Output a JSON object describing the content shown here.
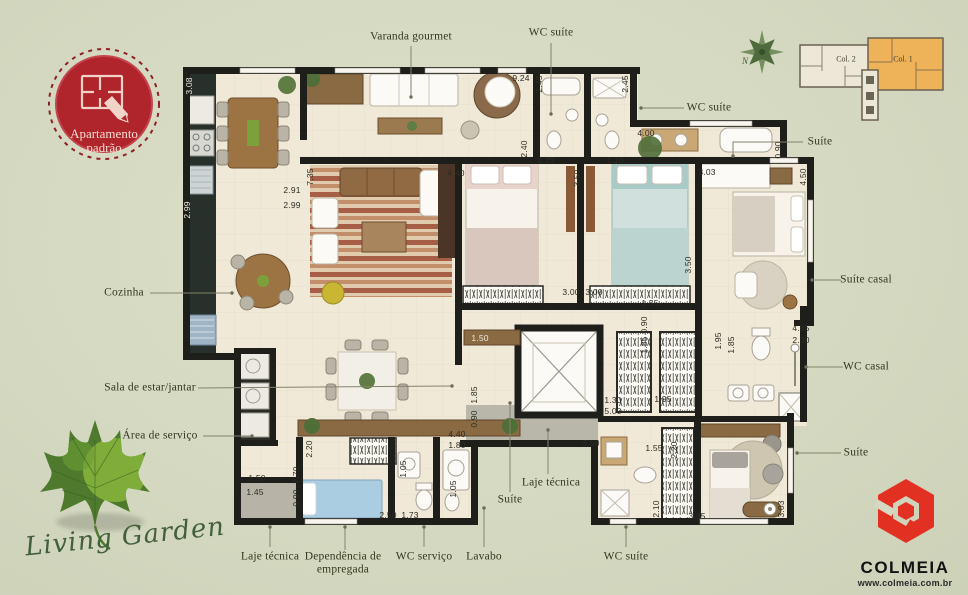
{
  "badge": {
    "line1": "Apartamento",
    "line2": "padrão"
  },
  "compass": {
    "n": "N"
  },
  "keyplan": {
    "col2": "Col. 2",
    "col1": "Col. 1"
  },
  "brand": {
    "name": "COLMEIA",
    "url": "www.colmeia.com.br",
    "red": "#e23122"
  },
  "watermark": {
    "text": "Living Garden"
  },
  "colors": {
    "background": "#d5d9c1",
    "wall": "#1e1e1b",
    "floor": "#f0e9d8",
    "badge_red": "#b0242b",
    "keyplan_orange": "#eeb259",
    "leaf_green": "#557a2e"
  },
  "plan": {
    "labels": [
      {
        "id": "varanda-gourmet",
        "text": "Varanda gourmet",
        "x": 411,
        "y": 37,
        "leader": [
          [
            411,
            46
          ],
          [
            411,
            97
          ]
        ]
      },
      {
        "id": "wc-suite-top",
        "text": "WC suíte",
        "x": 551,
        "y": 33,
        "leader": [
          [
            551,
            43
          ],
          [
            551,
            114
          ]
        ]
      },
      {
        "id": "wc-suite-top-right",
        "text": "WC suíte",
        "x": 709,
        "y": 108,
        "leader": [
          [
            684,
            108
          ],
          [
            641,
            108
          ]
        ]
      },
      {
        "id": "suite-top-right",
        "text": "Suíte",
        "x": 820,
        "y": 142,
        "leader": [
          [
            803,
            142
          ],
          [
            733,
            142
          ],
          [
            733,
            156
          ]
        ]
      },
      {
        "id": "cozinha",
        "text": "Cozinha",
        "x": 124,
        "y": 293,
        "leader": [
          [
            150,
            293
          ],
          [
            232,
            293
          ]
        ]
      },
      {
        "id": "sala-estar-jantar",
        "text": "Sala de estar/jantar",
        "x": 150,
        "y": 388,
        "leader": [
          [
            198,
            388
          ],
          [
            452,
            386
          ]
        ]
      },
      {
        "id": "area-servico",
        "text": "Área de serviço",
        "x": 160,
        "y": 436,
        "leader": [
          [
            203,
            436
          ],
          [
            252,
            436
          ]
        ]
      },
      {
        "id": "suite-casal",
        "text": "Suíte casal",
        "x": 866,
        "y": 280,
        "leader": [
          [
            841,
            280
          ],
          [
            812,
            280
          ]
        ]
      },
      {
        "id": "wc-casal",
        "text": "WC casal",
        "x": 866,
        "y": 367,
        "leader": [
          [
            843,
            367
          ],
          [
            806,
            367
          ]
        ]
      },
      {
        "id": "suite-right",
        "text": "Suíte",
        "x": 856,
        "y": 453,
        "leader": [
          [
            841,
            453
          ],
          [
            797,
            453
          ]
        ]
      },
      {
        "id": "laje-tecnica-left",
        "text": "Laje técnica",
        "x": 270,
        "y": 557,
        "leader": [
          [
            270,
            547
          ],
          [
            270,
            527
          ]
        ]
      },
      {
        "id": "dependencia-empregada",
        "lines": [
          "Dependência de",
          "empregada"
        ],
        "x": 343,
        "y": 563,
        "leader": [
          [
            345,
            550
          ],
          [
            345,
            527
          ]
        ]
      },
      {
        "id": "wc-servico",
        "text": "WC serviço",
        "x": 424,
        "y": 557,
        "leader": [
          [
            424,
            547
          ],
          [
            424,
            527
          ]
        ]
      },
      {
        "id": "lavabo",
        "text": "Lavabo",
        "x": 484,
        "y": 557,
        "leader": [
          [
            484,
            547
          ],
          [
            484,
            508
          ]
        ]
      },
      {
        "id": "wc-suite-bottom",
        "text": "WC suíte",
        "x": 626,
        "y": 557,
        "leader": [
          [
            626,
            547
          ],
          [
            626,
            527
          ]
        ]
      },
      {
        "id": "laje-tecnica-center",
        "text": "Laje técnica",
        "x": 551,
        "y": 483,
        "leader": [
          [
            548,
            474
          ],
          [
            548,
            430
          ]
        ]
      },
      {
        "id": "suite-center",
        "text": "Suíte",
        "x": 510,
        "y": 500,
        "leader": [
          [
            510,
            492
          ],
          [
            510,
            403
          ]
        ]
      }
    ],
    "dims": [
      {
        "v": "9.24",
        "x": 521,
        "y": 78
      },
      {
        "v": "2.45",
        "x": 539,
        "y": 84,
        "rot": 1
      },
      {
        "v": "2.45",
        "x": 625,
        "y": 84,
        "rot": 1
      },
      {
        "v": "4.00",
        "x": 646,
        "y": 133
      },
      {
        "v": "0.90",
        "x": 778,
        "y": 150,
        "rot": 1
      },
      {
        "v": "4.50",
        "x": 803,
        "y": 177,
        "rot": 1
      },
      {
        "v": "2.40",
        "x": 524,
        "y": 149,
        "rot": 1
      },
      {
        "v": "1.25",
        "x": 546,
        "y": 160
      },
      {
        "v": "1.10",
        "x": 615,
        "y": 160
      },
      {
        "v": "4.40",
        "x": 456,
        "y": 173
      },
      {
        "v": "3.50",
        "x": 577,
        "y": 178,
        "rot": 1
      },
      {
        "v": "3.03",
        "x": 707,
        "y": 172
      },
      {
        "v": "2.91",
        "x": 292,
        "y": 190
      },
      {
        "v": "2.99",
        "x": 292,
        "y": 205
      },
      {
        "v": "7.35",
        "x": 310,
        "y": 177,
        "rot": 1
      },
      {
        "v": "3.08",
        "x": 189,
        "y": 86,
        "rot": 1,
        "light": true
      },
      {
        "v": "2.99",
        "x": 187,
        "y": 210,
        "rot": 1,
        "light": true
      },
      {
        "v": "3.00",
        "x": 571,
        "y": 292
      },
      {
        "v": "3.00",
        "x": 594,
        "y": 292
      },
      {
        "v": "1.55",
        "x": 650,
        "y": 303
      },
      {
        "v": "0.90",
        "x": 644,
        "y": 325,
        "rot": 1
      },
      {
        "v": "3.50",
        "x": 688,
        "y": 265,
        "rot": 1
      },
      {
        "v": "3.60",
        "x": 706,
        "y": 285,
        "rot": 1,
        "light": true
      },
      {
        "v": "1.85",
        "x": 644,
        "y": 345,
        "rot": 1
      },
      {
        "v": "1.95",
        "x": 718,
        "y": 341,
        "rot": 1
      },
      {
        "v": "1.85",
        "x": 731,
        "y": 345,
        "rot": 1
      },
      {
        "v": "1.95",
        "x": 663,
        "y": 399
      },
      {
        "v": "4.65",
        "x": 801,
        "y": 328
      },
      {
        "v": "2.30",
        "x": 801,
        "y": 340
      },
      {
        "v": "1.50",
        "x": 480,
        "y": 338,
        "light": true
      },
      {
        "v": "1.85",
        "x": 474,
        "y": 395,
        "rot": 1
      },
      {
        "v": "0.90",
        "x": 474,
        "y": 419,
        "rot": 1
      },
      {
        "v": "1.30",
        "x": 613,
        "y": 400
      },
      {
        "v": "5.00",
        "x": 613,
        "y": 411
      },
      {
        "v": "4.40",
        "x": 457,
        "y": 434
      },
      {
        "v": "1.80",
        "x": 457,
        "y": 445
      },
      {
        "v": "2.20",
        "x": 309,
        "y": 449,
        "rot": 1
      },
      {
        "v": "7.70",
        "x": 296,
        "y": 475,
        "rot": 1
      },
      {
        "v": "0.90",
        "x": 296,
        "y": 498,
        "rot": 1
      },
      {
        "v": "1.50",
        "x": 257,
        "y": 478
      },
      {
        "v": "1.45",
        "x": 255,
        "y": 492
      },
      {
        "v": "1.05",
        "x": 403,
        "y": 469,
        "rot": 1
      },
      {
        "v": "1.05",
        "x": 453,
        "y": 489,
        "rot": 1
      },
      {
        "v": "2.50",
        "x": 388,
        "y": 515
      },
      {
        "v": "1.73",
        "x": 410,
        "y": 515
      },
      {
        "v": "3.50",
        "x": 591,
        "y": 443
      },
      {
        "v": "1.55",
        "x": 654,
        "y": 448
      },
      {
        "v": "2.20",
        "x": 674,
        "y": 450,
        "rot": 1
      },
      {
        "v": "2.10",
        "x": 656,
        "y": 509,
        "rot": 1
      },
      {
        "v": "3.35",
        "x": 697,
        "y": 516
      },
      {
        "v": "3.03",
        "x": 781,
        "y": 509,
        "rot": 1
      }
    ]
  }
}
